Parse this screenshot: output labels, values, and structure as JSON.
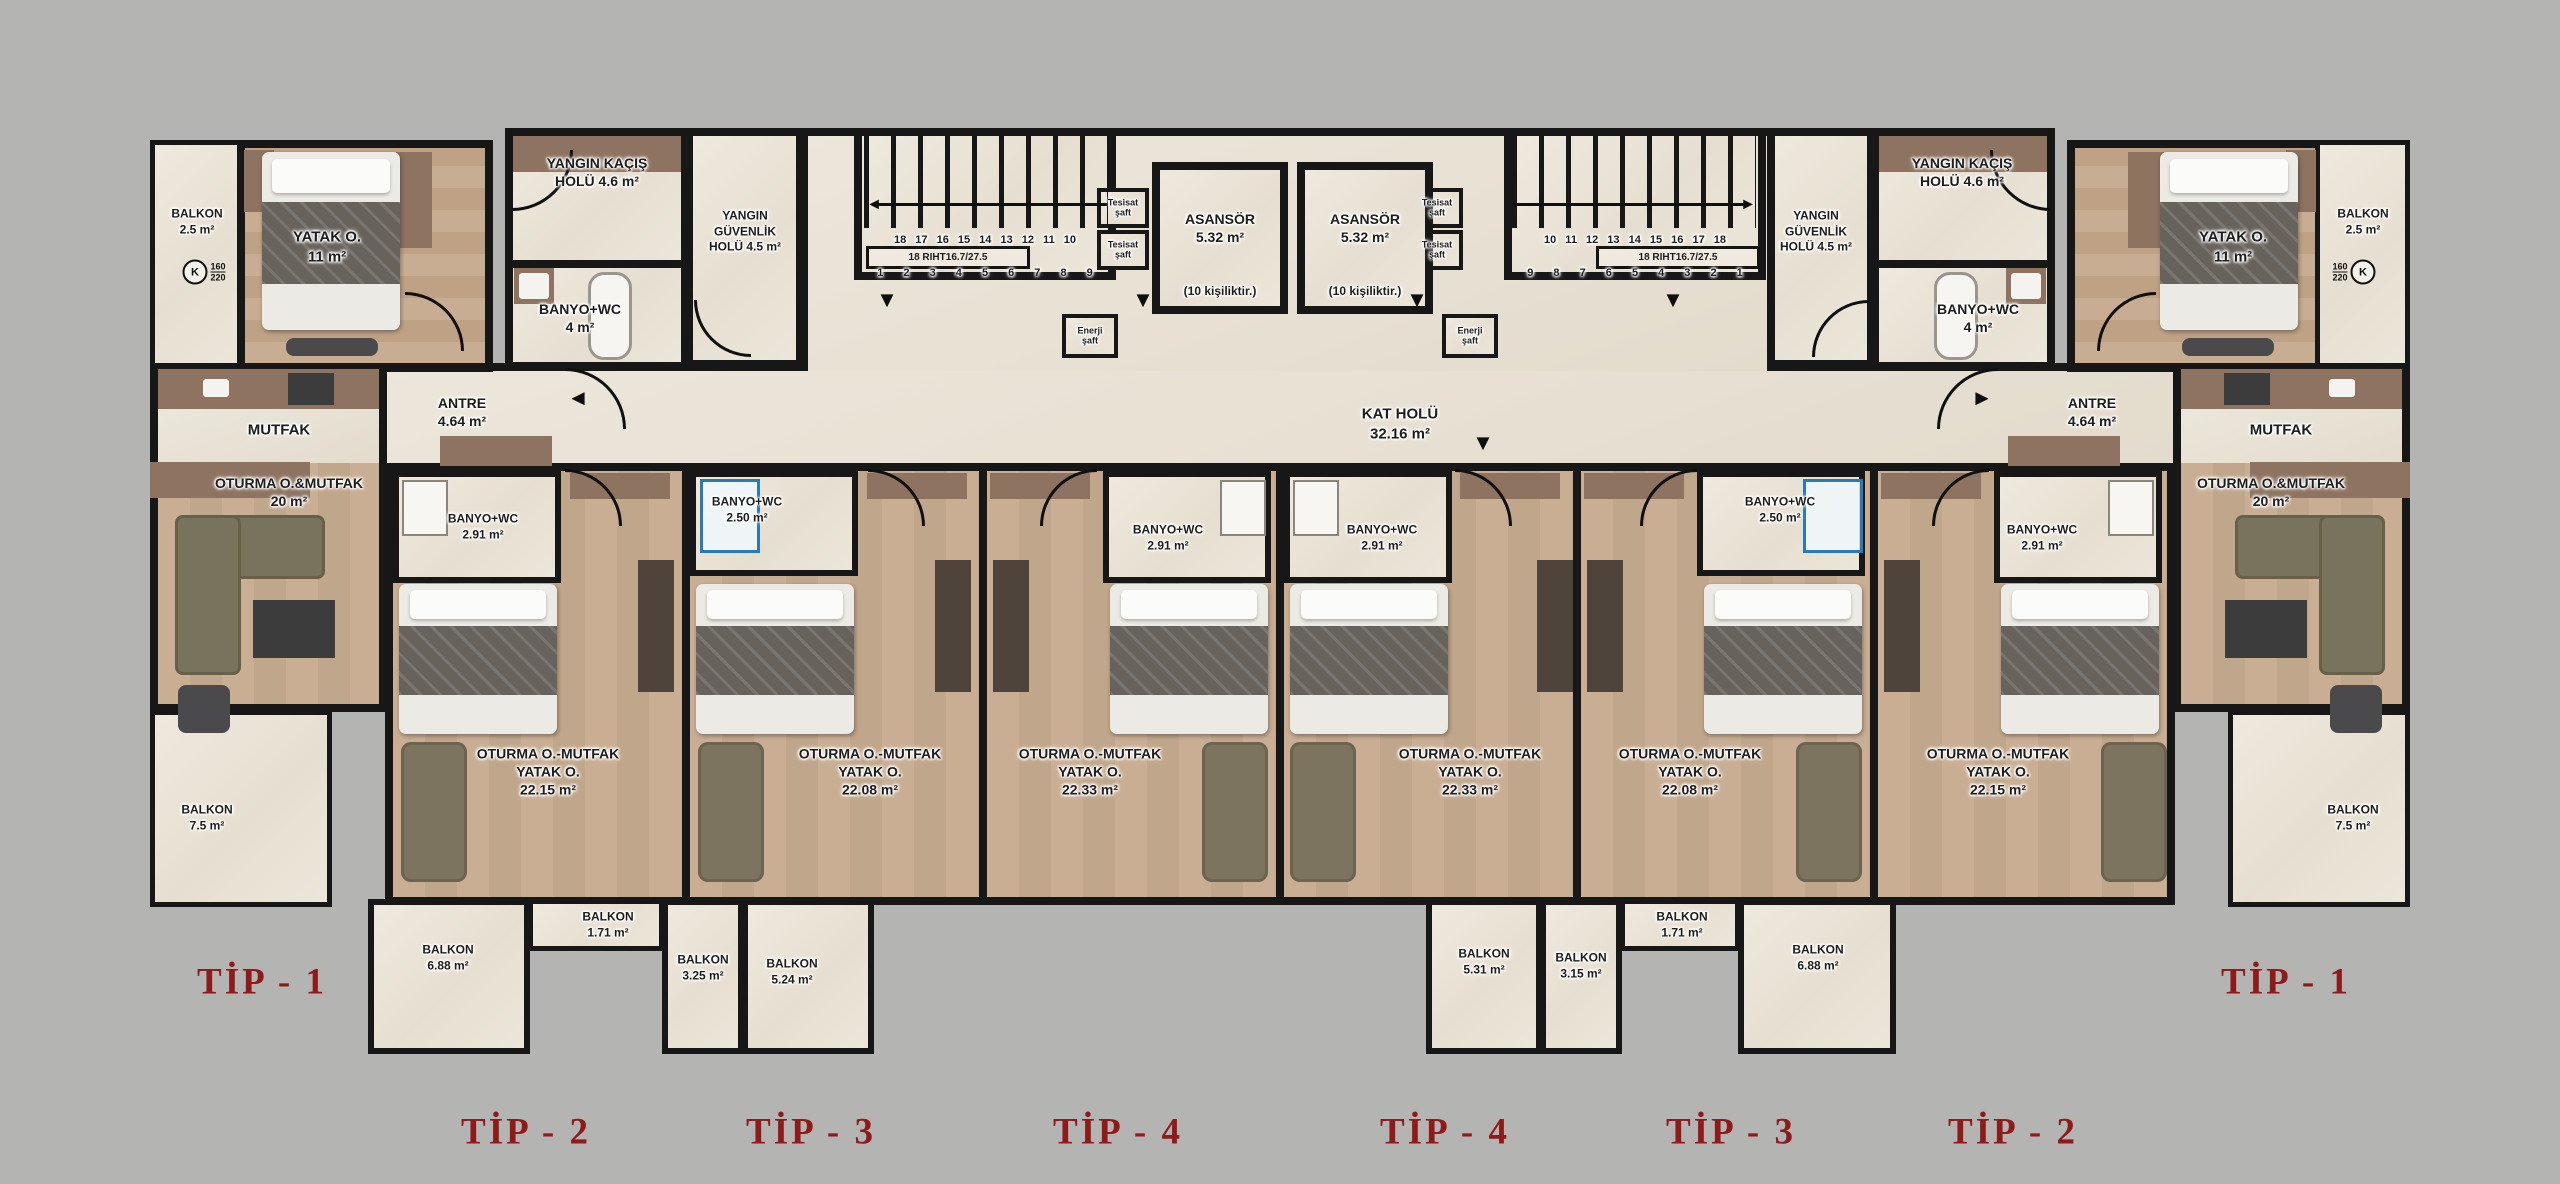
{
  "wing": {
    "balkon_ust": "BALKON\n2.5 m²",
    "yatak": "YATAK O.\n11 m²",
    "antre": "ANTRE\n4.64 m²",
    "mutfak": "MUTFAK",
    "oturma": "OTURMA O.&MUTFAK\n20 m²",
    "balkon_yan": "BALKON\n7.5 m²"
  },
  "marker": {
    "k": "K",
    "ust": "160",
    "alt": "220"
  },
  "core": {
    "yangin_kacis": "YANGIN KAÇIŞ\nHOLÜ  4.6 m²",
    "yangin_guvenlik": "YANGIN\nGÜVENLİK\nHOLÜ  4.5 m²",
    "banyo": "BANYO+WC\n4 m²",
    "asansor": "ASANSÖR\n5.32 m²",
    "asansor_not": "(10 kişiliktir.)",
    "kat_holu": "KAT HOLÜ\n32.16 m²",
    "tesisat_saft": "Tesisat\nşaft",
    "enerji_saft": "Enerji\nşaft",
    "riht": "18 RIHT16.7/27.5",
    "stair_left_top": "18 17 16 15 14 13 12 11 10",
    "stair_left_bottom": "1 2 3 4 5 6 7 8 9",
    "stair_right_top": "10 11 12 13 14 15 16 17 18",
    "stair_right_bottom": "9 8 7 6 5 4 3 2 1"
  },
  "units": [
    {
      "bath": "BANYO+WC\n2.91 m²",
      "living": "OTURMA O.-MUTFAK\nYATAK O.\n22.15 m²"
    },
    {
      "bath": "BANYO+WC\n2.50 m²",
      "living": "OTURMA O.-MUTFAK\nYATAK O.\n22.08 m²"
    },
    {
      "bath": "BANYO+WC\n2.91 m²",
      "living": "OTURMA O.-MUTFAK\nYATAK O.\n22.33 m²"
    },
    {
      "bath": "BANYO+WC\n2.91 m²",
      "living": "OTURMA O.-MUTFAK\nYATAK O.\n22.33 m²"
    },
    {
      "bath": "BANYO+WC\n2.50 m²",
      "living": "OTURMA O.-MUTFAK\nYATAK O.\n22.08 m²"
    },
    {
      "bath": "BANYO+WC\n2.91 m²",
      "living": "OTURMA O.-MUTFAK\nYATAK O.\n22.15 m²"
    }
  ],
  "bottom_balconies": [
    "BALKON\n6.88 m²",
    "BALKON\n1.71 m²",
    "BALKON\n3.25 m²",
    "BALKON\n5.24 m²",
    "BALKON\n5.31 m²",
    "BALKON\n3.15 m²",
    "BALKON\n1.71 m²",
    "BALKON\n6.88 m²"
  ],
  "tips": [
    "TİP - 1",
    "TİP - 2",
    "TİP - 3",
    "TİP - 4",
    "TİP - 4",
    "TİP - 3",
    "TİP - 2",
    "TİP - 1"
  ],
  "arrows": {
    "down": "▼",
    "left": "◄",
    "right": "►"
  },
  "colors": {
    "background": "#b4b4b2",
    "wall": "#171717",
    "tip": "#8e1a1a",
    "blue": "#2b7ab8",
    "brown": "#8d7360"
  }
}
